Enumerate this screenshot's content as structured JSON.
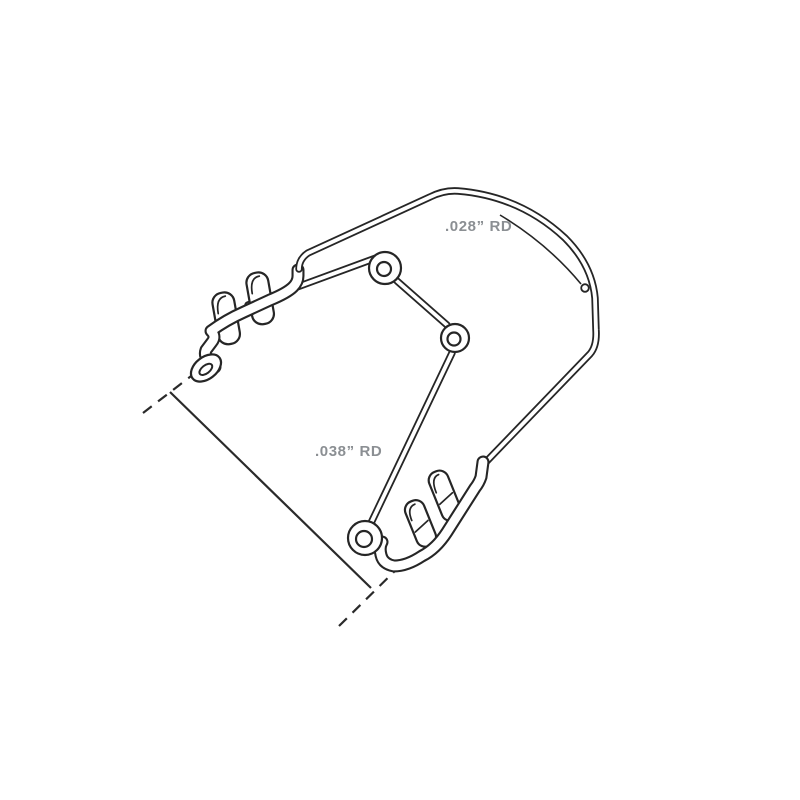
{
  "drawing": {
    "labels": {
      "wire_028": ".028” RD",
      "wire_038": ".038” RD"
    },
    "colors": {
      "line": "#262626",
      "label_text": "#8b8f93",
      "background": "#ffffff"
    }
  }
}
